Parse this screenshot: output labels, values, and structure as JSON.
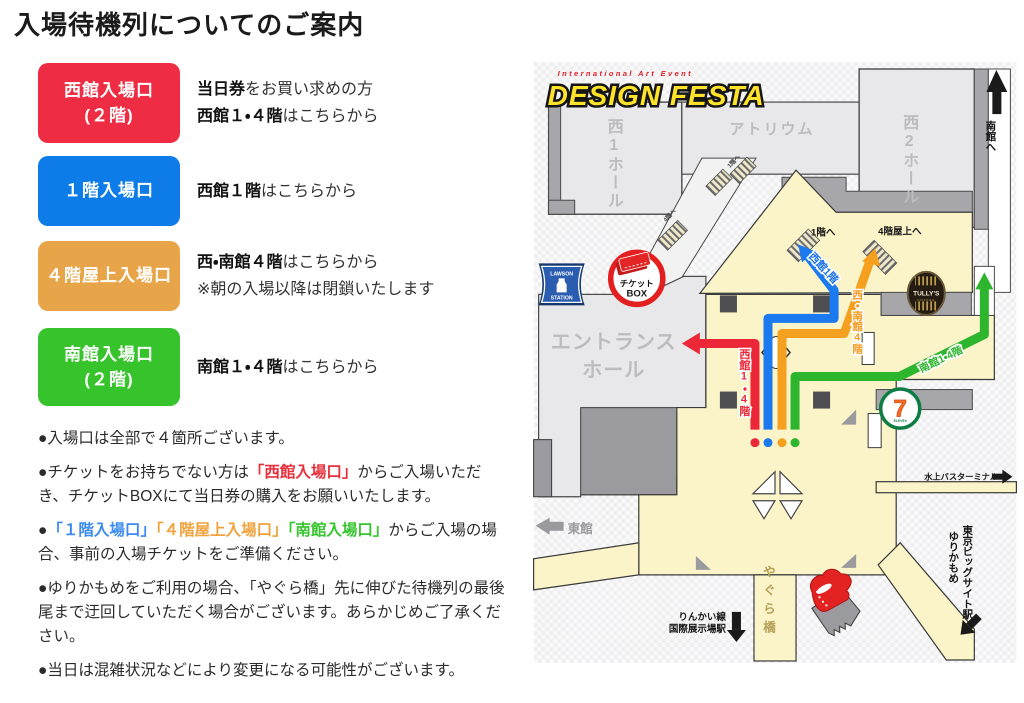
{
  "page": {
    "title": "入場待機列についてのご案内"
  },
  "entrances": [
    {
      "id": "west",
      "color": "#ee2c44",
      "label_lines": [
        "西館入場口",
        "(２階)"
      ],
      "desc": [
        [
          {
            "t": "当日券",
            "b": true
          },
          {
            "t": "をお買い求めの方"
          }
        ],
        [
          {
            "t": "西館１・４階",
            "b": true
          },
          {
            "t": "はこちらから"
          }
        ]
      ]
    },
    {
      "id": "first-floor",
      "color": "#0d7ce8",
      "label_lines": [
        "１階入場口"
      ],
      "desc": [
        [
          {
            "t": "西館１階",
            "b": true
          },
          {
            "t": "はこちらから"
          }
        ]
      ]
    },
    {
      "id": "roof",
      "color": "#e8a449",
      "label_lines": [
        "４階屋上入場口"
      ],
      "desc": [
        [
          {
            "t": "西・南館４階",
            "b": true
          },
          {
            "t": "はこちらから"
          }
        ],
        [
          {
            "t": "※朝の入場以降は閉鎖いたします"
          }
        ]
      ]
    },
    {
      "id": "south",
      "color": "#36c32c",
      "label_lines": [
        "南館入場口",
        "(２階)"
      ],
      "desc": [
        [
          {
            "t": "南館１・４階",
            "b": true
          },
          {
            "t": "はこちらから"
          }
        ]
      ]
    }
  ],
  "notes": [
    [
      {
        "t": "●入場口は全部で４箇所ございます。"
      }
    ],
    [
      {
        "t": "●チケットをお持ちでない方は"
      },
      {
        "t": "「西館入場口」",
        "c": "red",
        "b": true
      },
      {
        "t": "からご入場いただき、チケットBOXにて当日券の購入をお願いいたします。"
      }
    ],
    [
      {
        "t": "●"
      },
      {
        "t": "「１階入場口」",
        "c": "blue",
        "b": true
      },
      {
        "t": "「４階屋上入場口」",
        "c": "orange",
        "b": true
      },
      {
        "t": "「南館入場口」",
        "c": "green",
        "b": true
      },
      {
        "t": "からご入場の場合、事前の入場チケットをご準備ください。"
      }
    ],
    [
      {
        "t": "●ゆりかもめをご利用の場合、「やぐら橋」先に伸びた待機列の最後尾まで迂回していただく場合がございます。あらかじめご了承ください。"
      }
    ],
    [
      {
        "t": "●当日は混雑状況などにより変更になる可能性がございます。"
      }
    ]
  ],
  "map": {
    "logo": {
      "tagline": "International Art Event",
      "title": "DESIGN FESTA"
    },
    "labels": {
      "west1_hall": "西1ホール",
      "atrium": "アトリウム",
      "west2_hall": "西2ホール",
      "to_south": "南館へ",
      "to_1f": "1階へ",
      "to_roof": "4階屋上へ",
      "stairs_4f": "4階へ",
      "entrance_hall_1": "エントランス",
      "entrance_hall_2": "ホール",
      "east_hall": "東館",
      "ticket_box_1": "チケット",
      "ticket_box_2": "BOX",
      "lawson_1": "LAWSON",
      "lawson_2": "STATION",
      "tullys": "TULLY'S",
      "tullys_sub": "COFFEE",
      "seven": "7",
      "seven_sub": "ELEVEn",
      "route_west": "西館1・4階",
      "route_1f": "西館1階",
      "route_roof": "西・南館4階",
      "route_south": "南館1・4階",
      "water_bus": "水上バスターミナル",
      "yurikamome_1": "ゆりかもめ",
      "yurikamome_2": "東京ビッグサイト駅",
      "rinkai_1": "りんかい線",
      "rinkai_2": "国際展示場駅",
      "yagura": "やぐら橋"
    },
    "colors": {
      "red": "#ec2838",
      "blue": "#1b7af0",
      "orange": "#f5a01e",
      "green": "#2db52d",
      "beige": "#fbf4c8"
    }
  }
}
